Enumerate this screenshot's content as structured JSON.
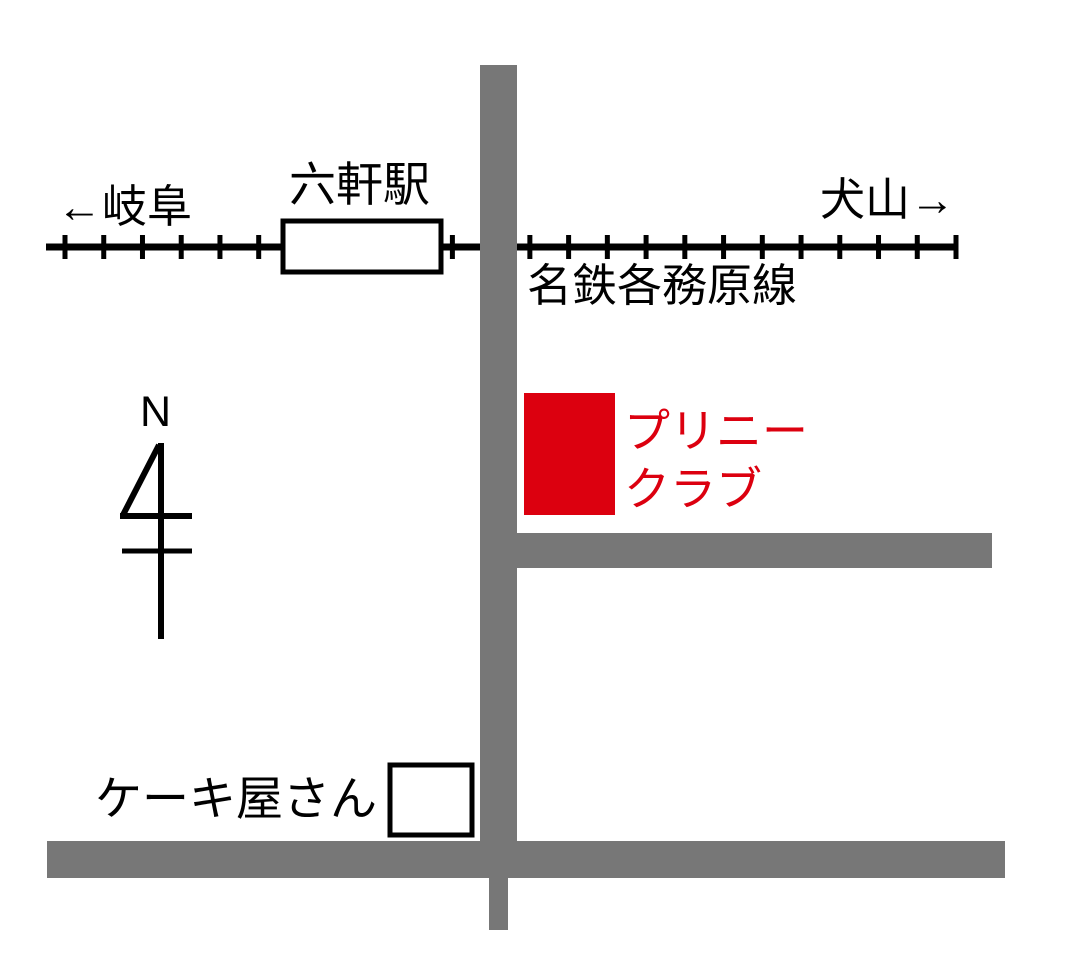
{
  "map": {
    "railway": {
      "line_name": "名鉄各務原線",
      "station_name": "六軒駅",
      "direction_west": "←岐阜",
      "direction_east": "犬山→"
    },
    "destination": {
      "line1": "プリニー",
      "line2": "クラブ"
    },
    "landmarks": {
      "cake_shop": "ケーキ屋さん"
    },
    "compass": {
      "north": "N"
    },
    "colors": {
      "road_gray": "#777777",
      "destination_red": "#dc000f",
      "railway_black": "#000000"
    }
  }
}
